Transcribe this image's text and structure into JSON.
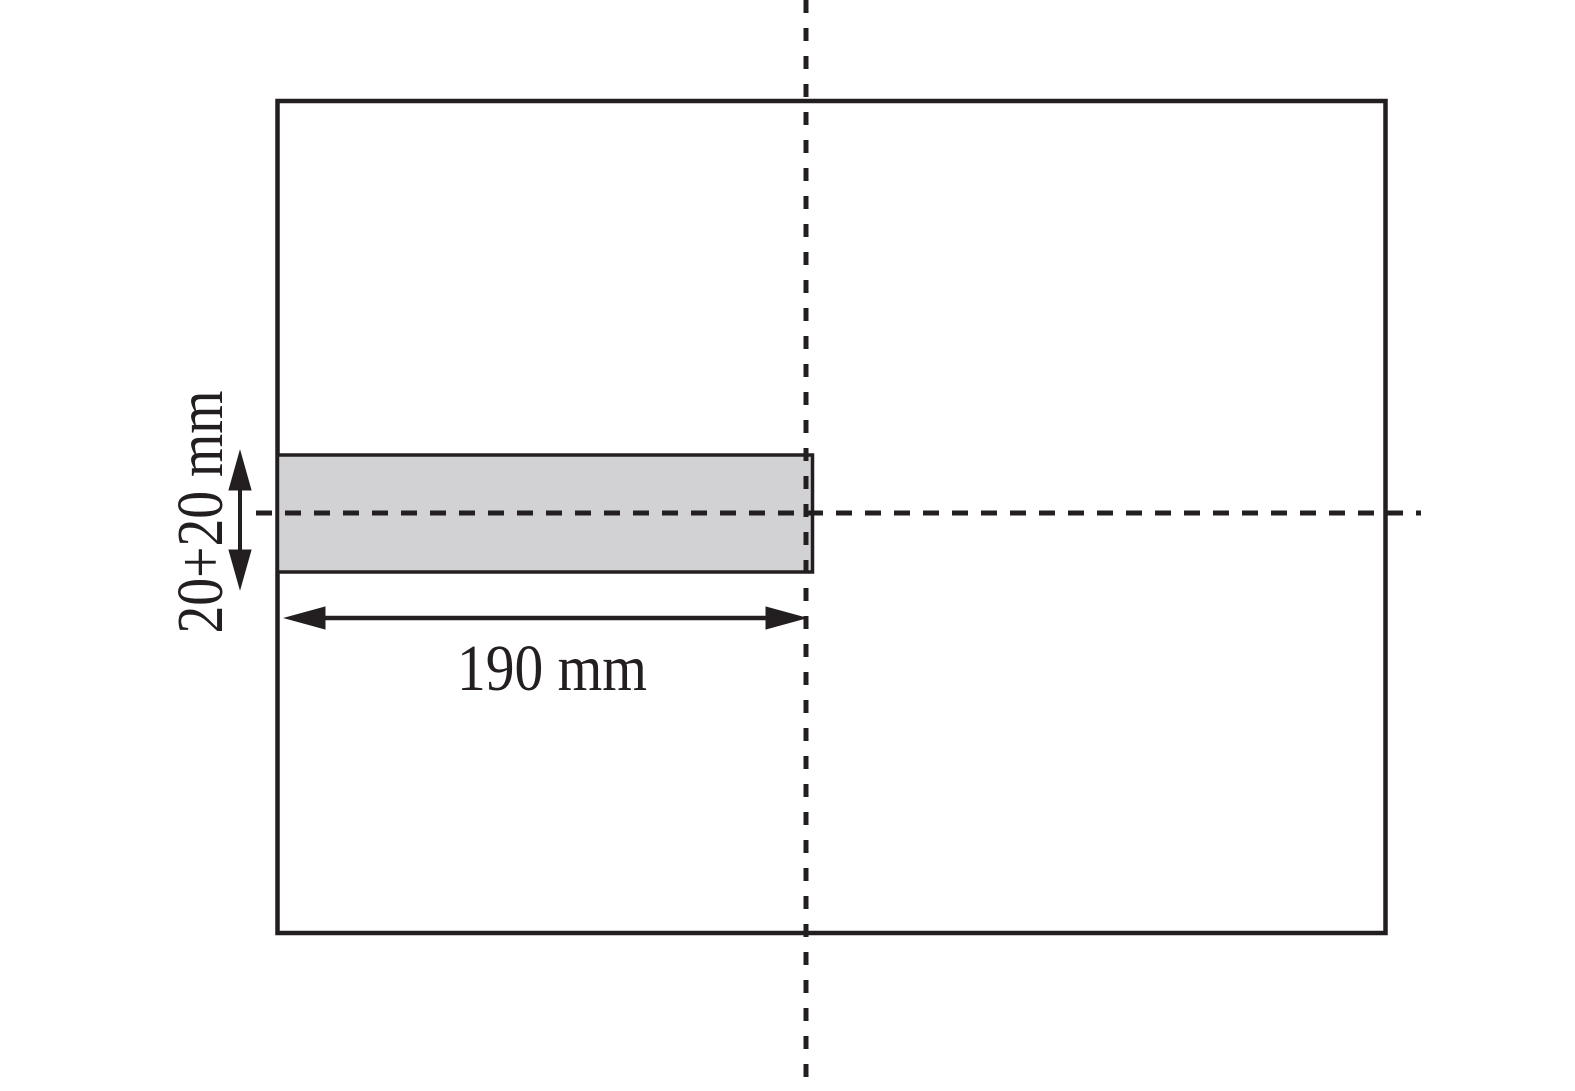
{
  "figure": {
    "labels": {
      "strip_height": "20+20 mm",
      "strip_length": "190 mm"
    },
    "colors": {
      "line": "#231f20",
      "strip_fill": "#d2d2d4",
      "background": "#ffffff"
    }
  }
}
